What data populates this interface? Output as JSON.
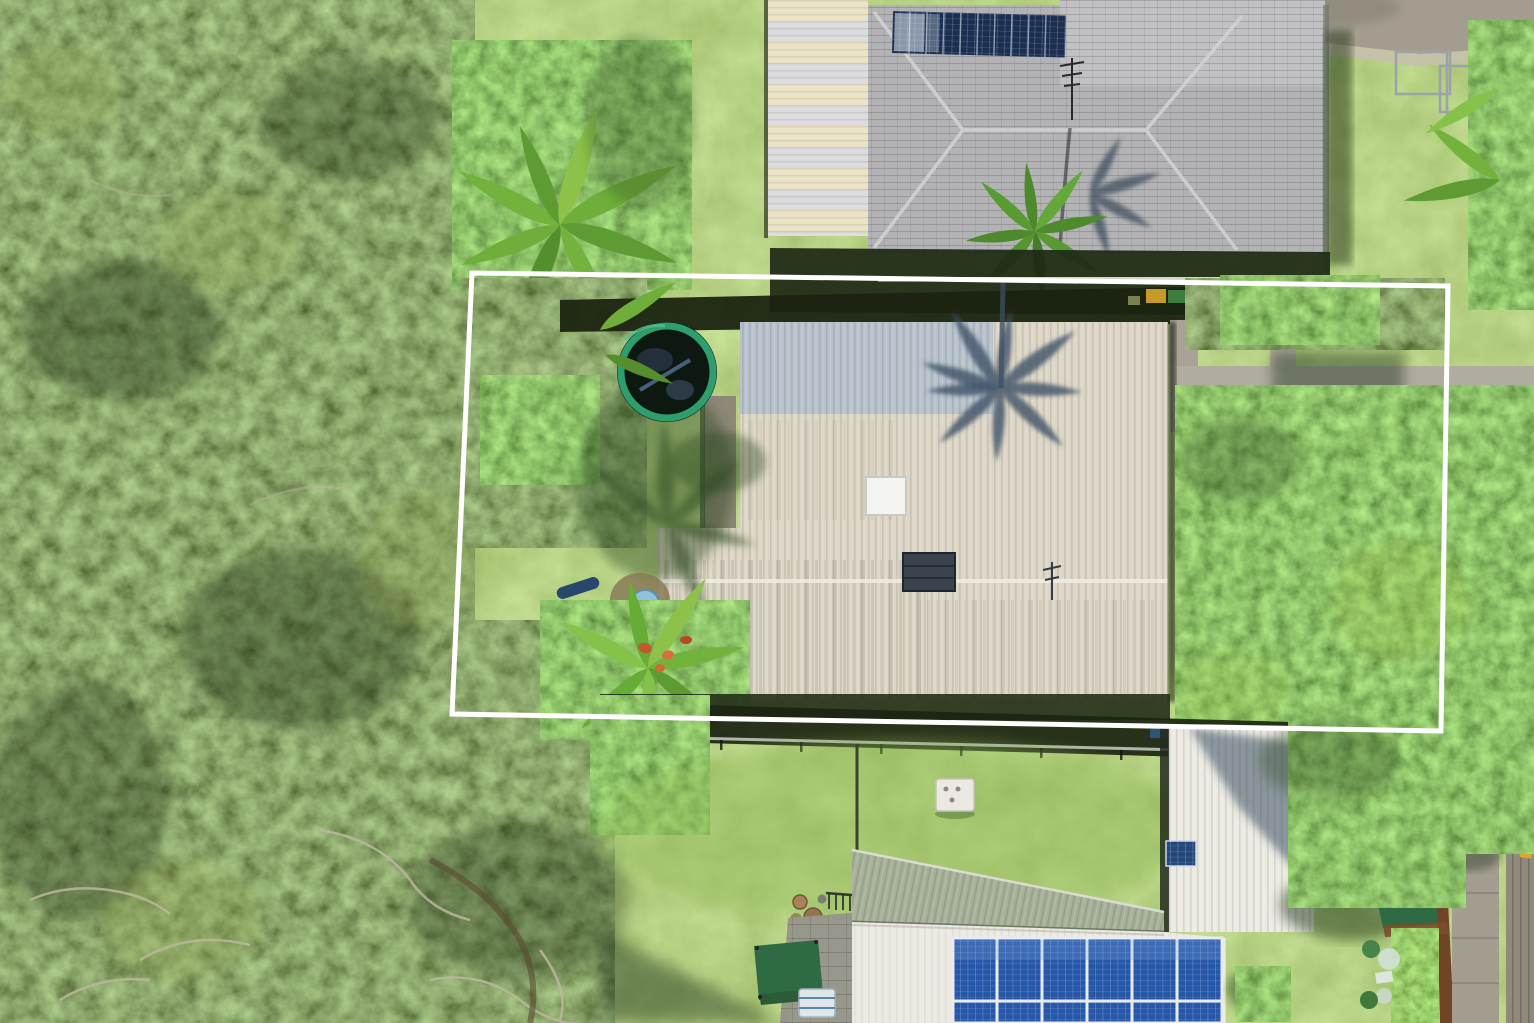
{
  "meta": {
    "type": "aerial-drone-photograph",
    "subject": "Residential property for sale with white lot boundary outline, tropical suburb, overhead view",
    "width": 1534,
    "height": 1023
  },
  "boundary": {
    "points": "472,273 1448,286 1441,731 452,714",
    "stroke_width": 5,
    "color": "#FFFFFF"
  },
  "palette": {
    "lawn": "#7CA94A",
    "forest": "#49591F",
    "canopy_bright": "#53A23A",
    "hedge": "#5FA83C",
    "boundary_line": "#FFFFFF",
    "roof_cream": "#DDD6C6",
    "roof_bluegray": "#B7C2CC",
    "roof_tile": "#B3B3B5",
    "roof_tile_light": "#C1C1C3",
    "roof_stripe_cream": "#EAE2C4",
    "roof_stripe_white": "#DBDBDE",
    "roof_sage": "#A7B199",
    "roof_white": "#ECEAE3",
    "solar_navy": "#1B2E4F",
    "solar_blue": "#2757A8",
    "path_concrete": "#B1ACA0",
    "road": "#A49D8F",
    "driveway": "#A39D90",
    "fence_band": "#1B2411",
    "trampoline_rim": "#2F9E6F",
    "trampoline_bed": "#0D1811",
    "pool_blue": "#8FC3DD",
    "kayak_blue": "#27476B",
    "shed_roof_green": "#2E6B44",
    "shed_trim_brown": "#6F4526",
    "crate_yellow": "#C79A27",
    "crate_green": "#3F7D3F",
    "table_white": "#ECE9E2",
    "lawn_shadow": "#2E4A21",
    "palm_roof_shadow": "#3D5168"
  },
  "objects": [
    {
      "name": "lot-boundary",
      "label": "white property boundary outline"
    },
    {
      "name": "main-house-roof",
      "label": "cream corrugated metal roof inside boundary"
    },
    {
      "name": "bluegray-roof-section",
      "label": "blue-gray corrugated roof section"
    },
    {
      "name": "palm-shadow-on-roof",
      "label": "palm tree shadow cast on roof"
    },
    {
      "name": "skylight",
      "label": "roof skylight"
    },
    {
      "name": "roof-vent",
      "label": "dark roof vent box"
    },
    {
      "name": "trampoline",
      "label": "round trampoline with green pads"
    },
    {
      "name": "paddling-pool",
      "label": "small blue paddling pool"
    },
    {
      "name": "kayak",
      "label": "blue kayak on lawn"
    },
    {
      "name": "neighbour-house-top",
      "label": "gray tiled hip roof house with solar panels"
    },
    {
      "name": "solar-row-top",
      "label": "row of dark solar panels on tiled roof"
    },
    {
      "name": "striped-roof-section",
      "label": "cream and white striped corrugated roof"
    },
    {
      "name": "tv-antenna",
      "label": "television antenna"
    },
    {
      "name": "street-top-right",
      "label": "concrete street corner"
    },
    {
      "name": "play-goal-frame",
      "label": "metal goal / swing frame on lawn"
    },
    {
      "name": "garden-paths",
      "label": "concrete garden paths"
    },
    {
      "name": "bright-canopy-right",
      "label": "sunlit green tree canopy"
    },
    {
      "name": "forest-left",
      "label": "dense native tree canopy"
    },
    {
      "name": "rear-fence",
      "label": "rear fence line with rail"
    },
    {
      "name": "lower-house-sage-roof",
      "label": "sage green skillion roof"
    },
    {
      "name": "lower-house-white-roof",
      "label": "white metal roof of rear neighbour"
    },
    {
      "name": "solar-array-bottom",
      "label": "large blue solar panel array"
    },
    {
      "name": "garden-shed",
      "label": "green-roofed garden shed with timber trim"
    },
    {
      "name": "driveway-bottom-right",
      "label": "concrete driveway"
    },
    {
      "name": "outdoor-table",
      "label": "small white outdoor table"
    },
    {
      "name": "pot-plants",
      "label": "terracotta pot plants"
    },
    {
      "name": "paver-patio",
      "label": "paved patio area"
    },
    {
      "name": "shade-canopy",
      "label": "green shade canopy"
    },
    {
      "name": "storage-crates",
      "label": "yellow and green crates by fence"
    }
  ]
}
